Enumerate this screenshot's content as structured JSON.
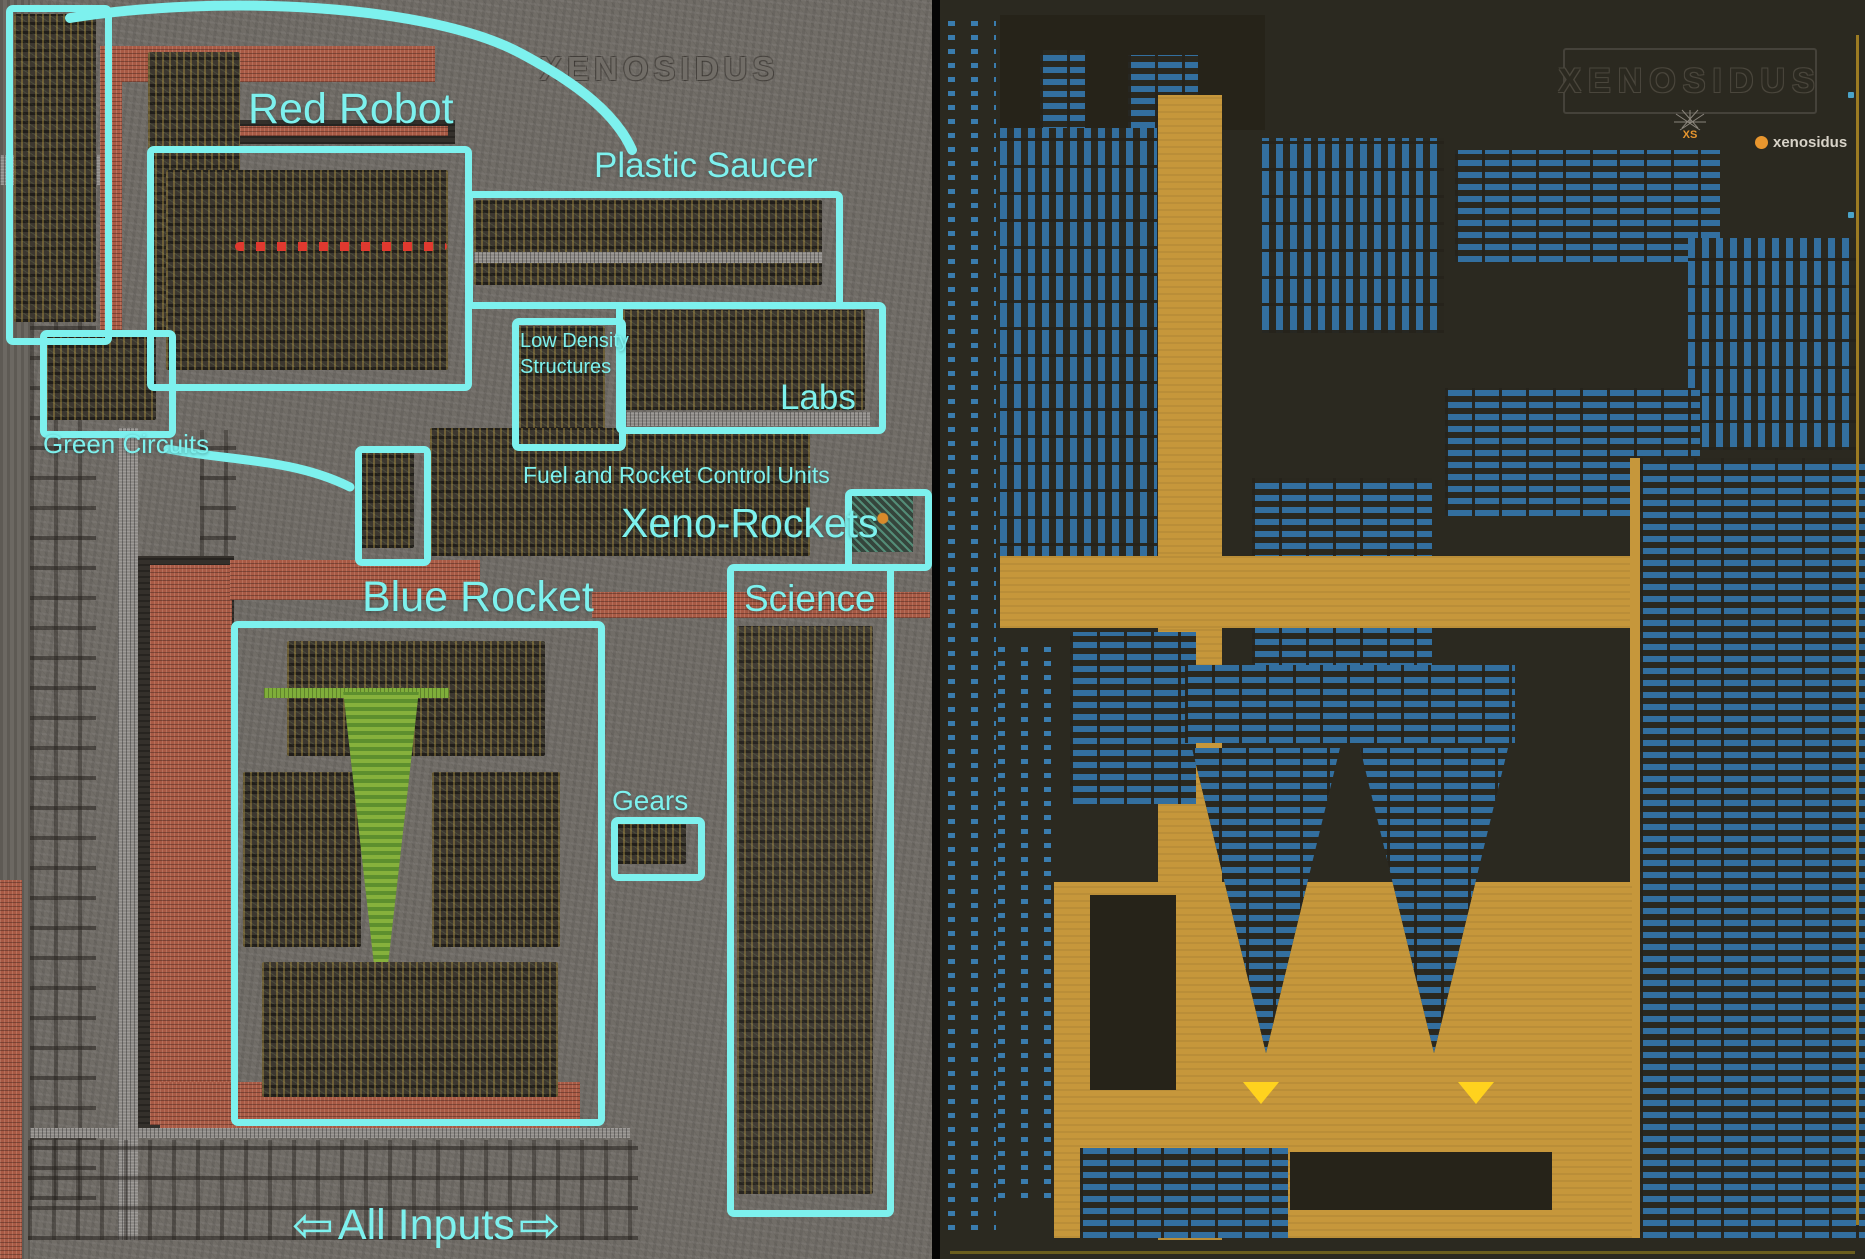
{
  "left_panel": {
    "watermark": "XENOSIDUS",
    "labels": {
      "red_robot": "Red Robot",
      "plastic_saucer": "Plastic Saucer",
      "green_circuits": "Green Circuits",
      "low_density_line1": "Low Density",
      "low_density_line2": "Structures",
      "labs": "Labs",
      "fuel": "Fuel and Rocket Control Units",
      "xeno_rockets": "Xeno-Rockets",
      "science": "Science",
      "blue_rocket": "Blue Rocket",
      "gears": "Gears",
      "all_inputs": "All Inputs"
    },
    "arrows": {
      "left": "⇦",
      "right": "⇨"
    }
  },
  "right_panel": {
    "logo": "XENOSIDUS",
    "logo_icon": "XS",
    "attribution": "xenosidus",
    "marker": "▼"
  },
  "colors": {
    "annotation_cyan": "#7df1ee",
    "stone_gray": "#716d67",
    "map_background": "#2b2920",
    "map_belt_tan": "#c6973b",
    "map_machine_blue": "#336f9f",
    "marker_yellow": "#ffd21e",
    "attribution_orange": "#e8962e",
    "red_belt": "#a85a45"
  }
}
